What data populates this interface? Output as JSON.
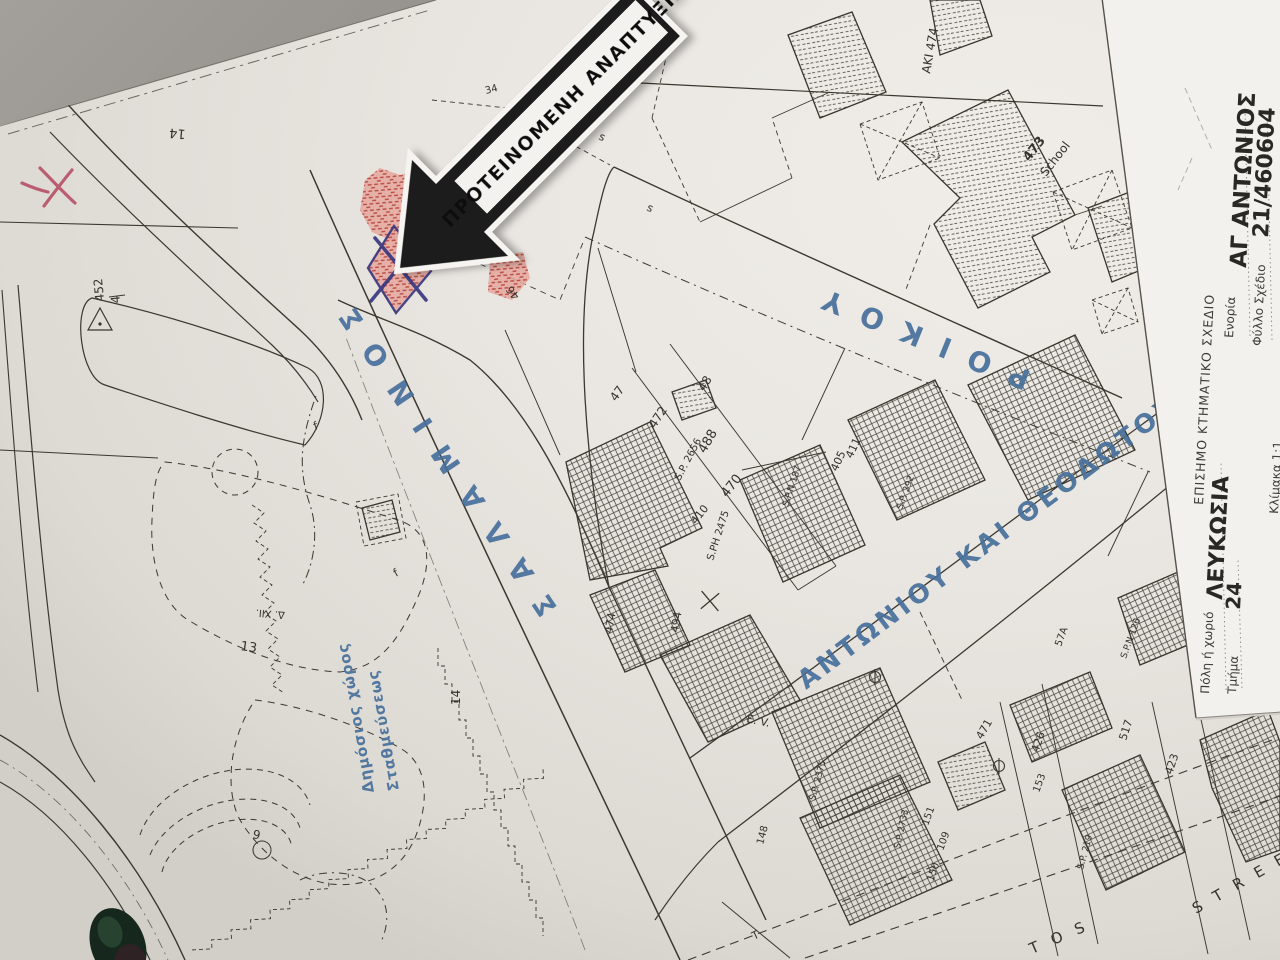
{
  "arrow": {
    "label": "ΠΡΟΤΕΙΝΟΜΕΝΗ ΑΝΑΠΤΥΞΗ"
  },
  "streets": {
    "salaminos": "ΣΑΛΑΜΙΝΟΣ",
    "roikou": "ΡΟΙΚΟΥ",
    "antoniou": "ΑΝΤΩΝΙΟΥ  ΚΑΙ  ΘΕΟΔΩΤΟΥ",
    "parking_line1": "Δημόσιος χώρος",
    "parking_line2": "Σταθμεύσεως",
    "street_tos": "TOS",
    "street_street": "STREET",
    "ev": "E. V.",
    "t": "T"
  },
  "sidebar": {
    "title": "ΕΠΙΣΗΜΟ ΚΤΗΜΑΤΙΚΟ ΣΧΕΔΙΟ",
    "parish_label": "Ενορία",
    "parish_value": "ΑΓ ΑΝΤΩΝΙΟΣ",
    "sheet_label": "Φύλλο  Σχέδιο",
    "sheet_value": "21/460604",
    "city_label": "Πόλη ή χωριό",
    "city_value": "ΛΕΥΚΩΣΙΑ",
    "section_label": "Τμήμα",
    "section_value": "24",
    "scale_label": "Κλίμακα 1:1"
  },
  "margin": {
    "ref": "ΑΚΙ 474"
  },
  "school": {
    "number": "473",
    "name": "School"
  },
  "labels": [
    {
      "t": "15"
    },
    {
      "t": "51"
    },
    {
      "t": "14"
    },
    {
      "t": "452"
    },
    {
      "t": "4"
    },
    {
      "t": "13"
    },
    {
      "t": "Δ. ΧΙΙ."
    },
    {
      "t": "14"
    },
    {
      "t": "9"
    },
    {
      "t": "46"
    },
    {
      "t": "47"
    },
    {
      "t": "472"
    },
    {
      "t": "48"
    },
    {
      "t": "488"
    },
    {
      "t": "S.P. 2656"
    },
    {
      "t": "470"
    },
    {
      "t": "410"
    },
    {
      "t": "S.PH 2475"
    },
    {
      "t": "S.P.N 187"
    },
    {
      "t": "474"
    },
    {
      "t": "494"
    },
    {
      "t": "405"
    },
    {
      "t": "411"
    },
    {
      "t": "S.P. 292"
    },
    {
      "t": "57A"
    },
    {
      "t": "S.P.N 126"
    },
    {
      "t": "471"
    },
    {
      "t": "426"
    },
    {
      "t": "153"
    },
    {
      "t": "517"
    },
    {
      "t": "423"
    },
    {
      "t": "S.P. 219"
    },
    {
      "t": "S.P. 2375"
    },
    {
      "t": "S.P 2733"
    },
    {
      "t": "148"
    },
    {
      "t": "151"
    },
    {
      "t": "109"
    },
    {
      "t": "150"
    },
    {
      "t": "34"
    },
    {
      "t": "s"
    },
    {
      "t": "s"
    },
    {
      "t": "f"
    },
    {
      "t": "f"
    }
  ],
  "colors": {
    "paper": "#e9e6e1",
    "ink": "#3a382f",
    "blue_ink": "#47709c",
    "red_hatch": "#b94b42",
    "sticker_black": "#1b1b1b"
  }
}
